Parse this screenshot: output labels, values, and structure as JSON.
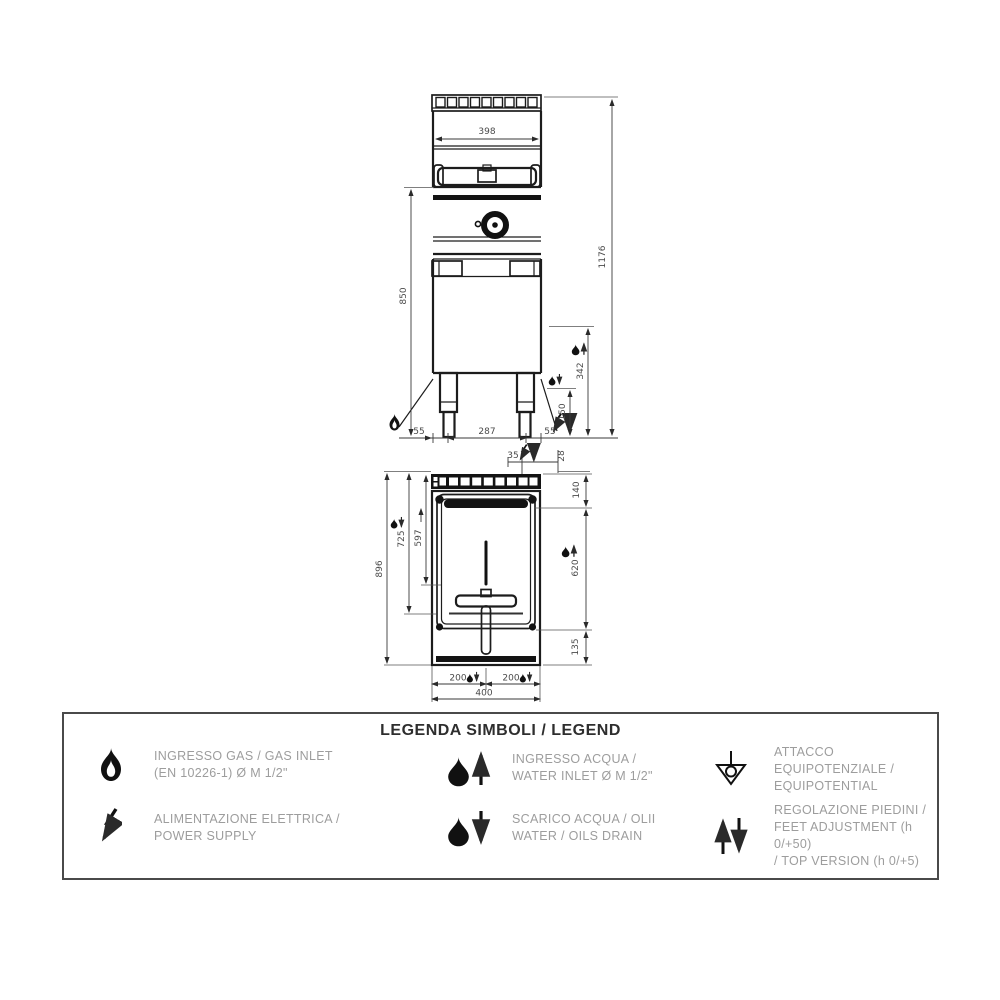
{
  "drawing": {
    "front_view": {
      "dims": {
        "width_top": "398",
        "height_total": "1176",
        "height_work": "850",
        "height_water_inlet": "342",
        "height_drain": "150",
        "foot_left": "55",
        "foot_span": "287",
        "foot_right": "55"
      }
    },
    "plan_view": {
      "dims": {
        "depth_total": "896",
        "depth_drain": "725",
        "depth_inlet": "597",
        "elec_offset": "35",
        "elec_edge": "28",
        "depth_top": "140",
        "depth_water": "620",
        "depth_bottom": "135",
        "drain_left": "200",
        "drain_right": "200",
        "width_total": "400"
      }
    }
  },
  "legend": {
    "title": "LEGENDA SIMBOLI / LEGEND",
    "items": [
      {
        "icon": "flame-icon",
        "line1": "INGRESSO GAS / GAS INLET",
        "line2": "(EN 10226-1) Ø M 1/2\""
      },
      {
        "icon": "lightning-icon",
        "line1": "ALIMENTAZIONE ELETTRICA /",
        "line2": "POWER SUPPLY"
      },
      {
        "icon": "water-inlet-icon",
        "line1": "INGRESSO ACQUA /",
        "line2": "WATER INLET Ø M 1/2\""
      },
      {
        "icon": "water-drain-icon",
        "line1": "SCARICO ACQUA / OLII",
        "line2": "WATER / OILS DRAIN"
      },
      {
        "icon": "equipotential-icon",
        "line1": "ATTACCO EQUIPOTENZIALE /",
        "line2": "EQUIPOTENTIAL"
      },
      {
        "icon": "feet-adjustment-icon",
        "line1": "REGOLAZIONE PIEDINI /",
        "line2": "FEET ADJUSTMENT (h 0/+50)",
        "line3": "/ TOP VERSION (h 0/+5)"
      }
    ]
  }
}
